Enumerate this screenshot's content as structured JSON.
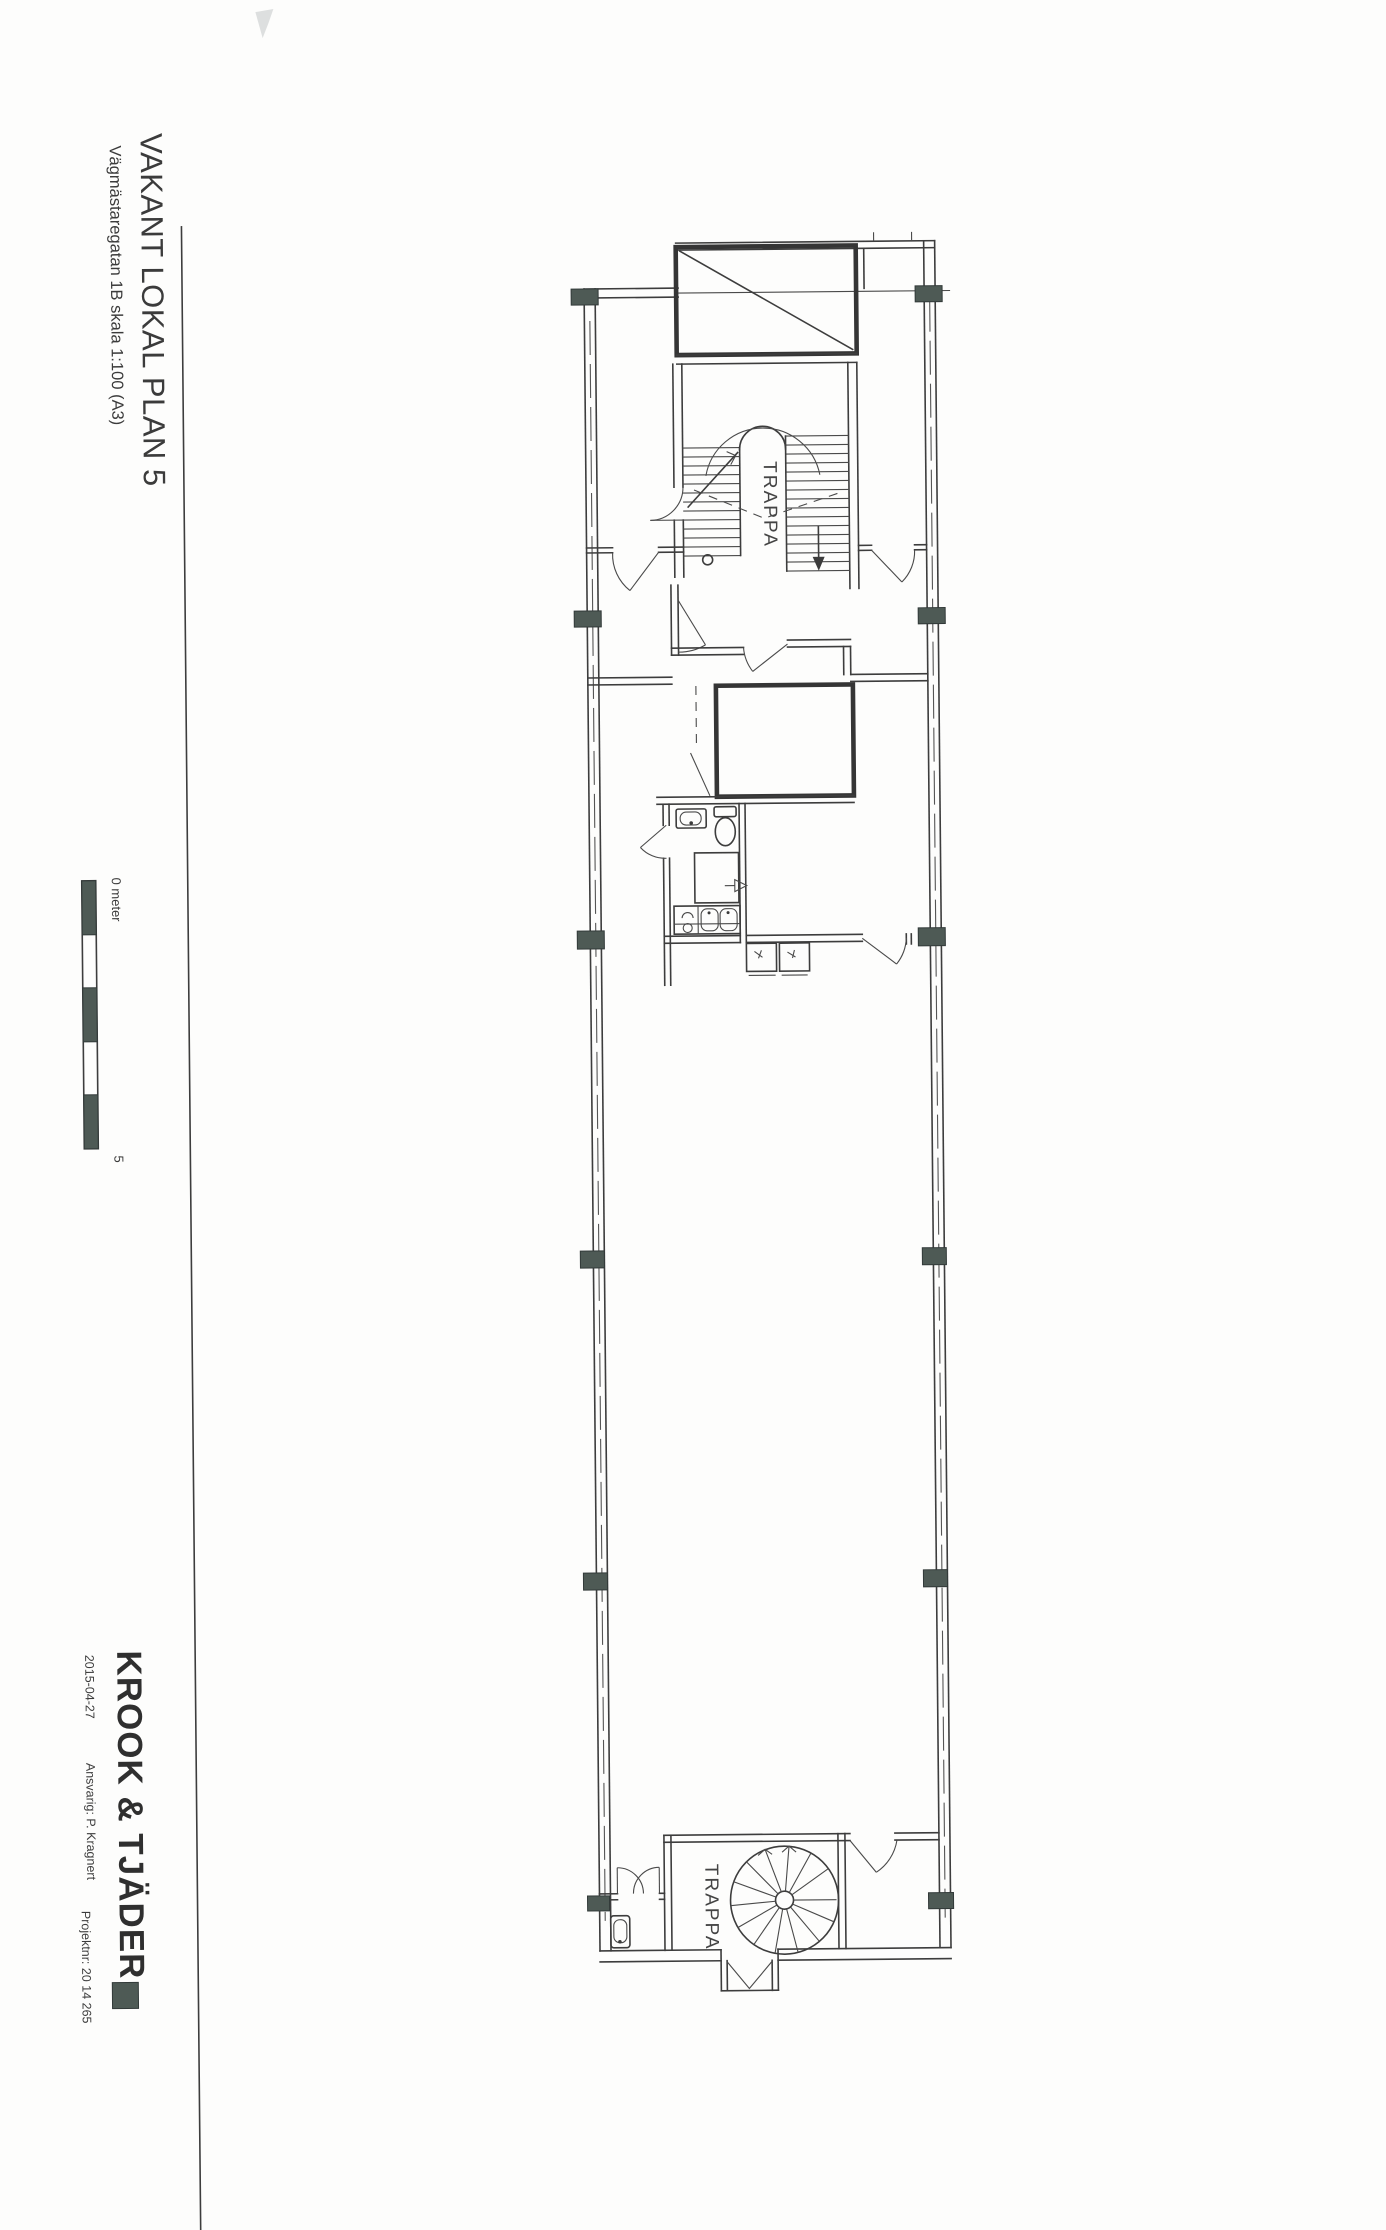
{
  "document": {
    "title": "VAKANT LOKAL PLAN 5",
    "subtitle": "Vägmästaregatan 1B skala 1:100 (A3)",
    "scale_bar": {
      "zero_label": "0 meter",
      "end_label": "5"
    },
    "plan_labels": {
      "stairwell_top": "TRAPPA",
      "stairwell_bottom": "TRAPPA"
    },
    "footer": {
      "company": "KROOK & TJÄDER",
      "date": "2015-04-27",
      "responsible": "Ansvarig: P. Kragnert",
      "project_number": "Projektnr: 20 14 265"
    },
    "colors": {
      "ink": "#3b3b3b",
      "column_fill": "#4e5a55",
      "paper": "#fdfdfc",
      "faint_mark": "#d9dcdb"
    }
  }
}
